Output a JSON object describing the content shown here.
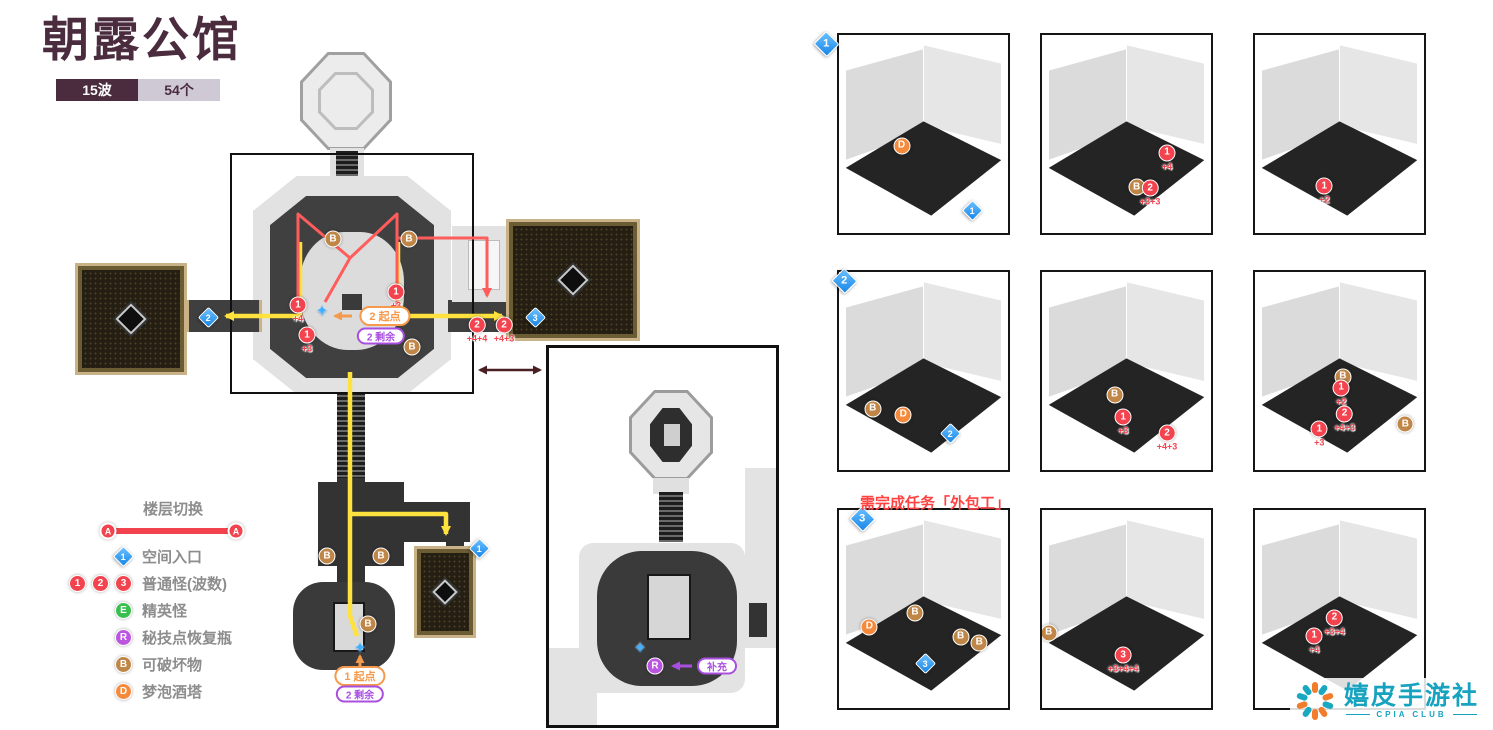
{
  "header": {
    "title": "朝露公馆",
    "wave_badge": "15波",
    "count_badge": "54个"
  },
  "legend": {
    "floor_switch": "楼层切换",
    "floor_marker": "A",
    "items": [
      {
        "type": "entry",
        "marker": "1",
        "label": "空间入口"
      },
      {
        "type": "waves",
        "markers": [
          "1",
          "2",
          "3"
        ],
        "label": "普通怪(波数)"
      },
      {
        "type": "elite",
        "marker": "E",
        "label": "精英怪"
      },
      {
        "type": "technique",
        "marker": "R",
        "label": "秘技点恢复瓶"
      },
      {
        "type": "breakable",
        "marker": "B",
        "label": "可破坏物"
      },
      {
        "type": "tower",
        "marker": "D",
        "label": "梦泡酒塔"
      }
    ]
  },
  "map": {
    "markers": [
      {
        "t": "entry",
        "label": "2",
        "x": 208,
        "y": 316
      },
      {
        "t": "entry",
        "label": "3",
        "x": 517,
        "y": 316
      },
      {
        "t": "entry",
        "label": "1",
        "x": 443,
        "y": 547
      },
      {
        "t": "wave",
        "label": "1",
        "sub": "+4",
        "x": 298,
        "y": 310
      },
      {
        "t": "wave",
        "label": "1",
        "sub": "+3",
        "x": 396,
        "y": 297
      },
      {
        "t": "wave",
        "label": "1",
        "sub": "+3",
        "x": 307,
        "y": 340
      },
      {
        "t": "wave",
        "label": "2",
        "sub": "+4+4",
        "x": 477,
        "y": 330
      },
      {
        "t": "wave",
        "label": "2",
        "sub": "+4+3",
        "x": 504,
        "y": 330
      },
      {
        "t": "b",
        "x": 412,
        "y": 347
      },
      {
        "t": "b",
        "x": 333,
        "y": 239
      },
      {
        "t": "b",
        "x": 409,
        "y": 239
      },
      {
        "t": "b",
        "x": 327,
        "y": 556
      },
      {
        "t": "b",
        "x": 381,
        "y": 556
      },
      {
        "t": "b",
        "x": 368,
        "y": 624
      },
      {
        "t": "star",
        "x": 322,
        "y": 311
      },
      {
        "t": "star",
        "x": 360,
        "y": 648
      },
      {
        "t": "star",
        "x": 640,
        "y": 648
      },
      {
        "t": "r",
        "x": 655,
        "y": 666
      }
    ],
    "pills": [
      {
        "style": "orange",
        "text": "2 起点",
        "x": 385,
        "y": 316
      },
      {
        "style": "purple",
        "text": "2 剩余",
        "x": 381,
        "y": 336
      },
      {
        "style": "orange",
        "text": "1 起点",
        "x": 360,
        "y": 676
      },
      {
        "style": "purple",
        "text": "2 剩余",
        "x": 360,
        "y": 694
      },
      {
        "style": "purple",
        "text": "补充",
        "x": 717,
        "y": 666
      }
    ],
    "routes": [
      {
        "color": "yellow",
        "points": [
          [
            300,
            242
          ],
          [
            300,
            316
          ],
          [
            226,
            316
          ]
        ],
        "arrow": "end",
        "dashed": false
      },
      {
        "color": "yellow",
        "points": [
          [
            398,
            242
          ],
          [
            398,
            316
          ],
          [
            502,
            316
          ]
        ],
        "arrow": "end",
        "dashed": false
      },
      {
        "color": "yellow",
        "points": [
          [
            350,
            372
          ],
          [
            350,
            514
          ],
          [
            446,
            514
          ],
          [
            446,
            534
          ]
        ],
        "arrow": "end",
        "dashed": false
      },
      {
        "color": "yellow",
        "points": [
          [
            350,
            514
          ],
          [
            350,
            616
          ],
          [
            357,
            636
          ]
        ],
        "arrow": "none",
        "dashed": false
      },
      {
        "color": "red",
        "points": [
          [
            298,
            306
          ],
          [
            298,
            214
          ],
          [
            350,
            258
          ]
        ],
        "arrow": "none",
        "dashed": false
      },
      {
        "color": "red",
        "points": [
          [
            397,
            306
          ],
          [
            397,
            214
          ],
          [
            350,
            258
          ]
        ],
        "arrow": "none",
        "dashed": false
      },
      {
        "color": "red",
        "points": [
          [
            397,
            238
          ],
          [
            487,
            238
          ],
          [
            487,
            296
          ]
        ],
        "arrow": "end",
        "dashed": false
      },
      {
        "color": "red",
        "points": [
          [
            350,
            258
          ],
          [
            325,
            302
          ]
        ],
        "arrow": "none",
        "dashed": false
      },
      {
        "color": "orange",
        "points": [
          [
            352,
            316
          ],
          [
            335,
            316
          ]
        ],
        "arrow": "end",
        "dashed": false
      },
      {
        "color": "orange",
        "points": [
          [
            360,
            667
          ],
          [
            360,
            656
          ]
        ],
        "arrow": "end",
        "dashed": false
      },
      {
        "color": "purple",
        "points": [
          [
            692,
            666
          ],
          [
            673,
            666
          ]
        ],
        "arrow": "end",
        "dashed": false
      },
      {
        "color": "maroon",
        "points": [
          [
            480,
            370
          ],
          [
            540,
            370
          ]
        ],
        "arrow": "both",
        "dashed": false
      }
    ]
  },
  "task_note": "需完成任务「外包工」",
  "rows": [
    {
      "num": "1"
    },
    {
      "num": "2"
    },
    {
      "num": "3"
    }
  ],
  "tiles": [
    {
      "markers": [
        {
          "t": "d",
          "x": 37,
          "y": 56
        },
        {
          "t": "entry",
          "label": "1",
          "x": 79,
          "y": 88
        }
      ],
      "paths": [
        {
          "points": [
            [
              78,
              84
            ],
            [
              60,
              73
            ],
            [
              73,
              62
            ]
          ],
          "arrow": "end",
          "dashed": false
        }
      ]
    },
    {
      "markers": [
        {
          "t": "b",
          "x": 56,
          "y": 77
        },
        {
          "t": "wave",
          "label": "1",
          "sub": "+4",
          "x": 74,
          "y": 62
        },
        {
          "t": "wave",
          "label": "2",
          "sub": "+3+3",
          "x": 64,
          "y": 80
        }
      ],
      "paths": [
        {
          "points": [
            [
              39,
              73
            ],
            [
              50,
              76
            ],
            [
              62,
              68
            ],
            [
              71,
              72
            ],
            [
              85,
              60
            ]
          ],
          "arrow": "end",
          "dashed": false
        }
      ]
    },
    {
      "markers": [
        {
          "t": "wave",
          "label": "1",
          "sub": "+2",
          "x": 41,
          "y": 79
        }
      ],
      "paths": [
        {
          "points": [
            [
              72,
              84
            ],
            [
              59,
              72
            ],
            [
              49,
              78
            ]
          ],
          "arrow": "end",
          "dashed": false
        }
      ]
    },
    {
      "markers": [
        {
          "t": "b",
          "x": 20,
          "y": 69
        },
        {
          "t": "d",
          "x": 38,
          "y": 72
        },
        {
          "t": "entry",
          "label": "2",
          "x": 66,
          "y": 81
        }
      ],
      "paths": [
        {
          "points": [
            [
              66,
              77
            ],
            [
              70,
              62
            ],
            [
              45,
              70
            ]
          ],
          "arrow": "end",
          "dashed": false
        },
        {
          "points": [
            [
              70,
              62
            ],
            [
              67,
              50
            ],
            [
              55,
              40
            ]
          ],
          "arrow": "none",
          "dashed": false
        },
        {
          "points": [
            [
              13,
              47
            ],
            [
              55,
              40
            ]
          ],
          "arrow": "both",
          "dashed": false
        }
      ]
    },
    {
      "markers": [
        {
          "t": "b",
          "x": 43,
          "y": 62
        },
        {
          "t": "wave",
          "label": "1",
          "sub": "+3",
          "x": 48,
          "y": 76
        },
        {
          "t": "wave",
          "label": "2",
          "sub": "+4+3",
          "x": 74,
          "y": 84
        }
      ],
      "paths": [
        {
          "points": [
            [
              3,
              62
            ],
            [
              70,
              81
            ]
          ],
          "arrow": "end",
          "dashed": false
        }
      ]
    },
    {
      "markers": [
        {
          "t": "b",
          "x": 52,
          "y": 53
        },
        {
          "t": "wave",
          "label": "1",
          "sub": "+2",
          "x": 51,
          "y": 61
        },
        {
          "t": "wave",
          "label": "2",
          "sub": "+4+3",
          "x": 53,
          "y": 74
        },
        {
          "t": "wave",
          "label": "1",
          "sub": "+3",
          "x": 38,
          "y": 82
        },
        {
          "t": "b",
          "x": 89,
          "y": 77
        }
      ],
      "paths": [
        {
          "points": [
            [
              69,
              88
            ],
            [
              69,
              64
            ],
            [
              59,
              57
            ]
          ],
          "arrow": "end",
          "dashed": false
        },
        {
          "points": [
            [
              58,
              70
            ],
            [
              41,
              78
            ]
          ],
          "arrow": "end",
          "dashed": false
        }
      ]
    },
    {
      "markers": [
        {
          "t": "d",
          "x": 18,
          "y": 59
        },
        {
          "t": "b",
          "x": 45,
          "y": 52
        },
        {
          "t": "b",
          "x": 72,
          "y": 64
        },
        {
          "t": "b",
          "x": 83,
          "y": 67
        },
        {
          "t": "entry",
          "label": "3",
          "x": 51,
          "y": 77
        }
      ],
      "paths": [
        {
          "points": [
            [
              51,
              73
            ],
            [
              33,
              71
            ],
            [
              20,
              64
            ],
            [
              38,
              58
            ],
            [
              58,
              58
            ],
            [
              58,
              51
            ]
          ],
          "arrow": "end",
          "dashed": false
        },
        {
          "points": [
            [
              70,
              48
            ],
            [
              84,
              45
            ],
            [
              81,
              25
            ],
            [
              44,
              16
            ]
          ],
          "arrow": "end",
          "dashed": true
        },
        {
          "points": [
            [
              44,
              16
            ],
            [
              10,
              24
            ],
            [
              8,
              56
            ]
          ],
          "arrow": "none",
          "dashed": true
        }
      ]
    },
    {
      "markers": [
        {
          "t": "b",
          "x": 4,
          "y": 62
        },
        {
          "t": "wave",
          "label": "3",
          "sub": "+3+4+4",
          "x": 48,
          "y": 76
        }
      ],
      "paths": []
    },
    {
      "markers": [
        {
          "t": "wave",
          "label": "2",
          "sub": "+3+4",
          "x": 47,
          "y": 57
        },
        {
          "t": "wave",
          "label": "1",
          "sub": "+4",
          "x": 35,
          "y": 66
        }
      ],
      "paths": [
        {
          "points": [
            [
              6,
              20
            ],
            [
              32,
              14
            ],
            [
              55,
              22
            ],
            [
              55,
              30
            ]
          ],
          "arrow": "none",
          "dashed": true
        },
        {
          "points": [
            [
              4,
              68
            ],
            [
              20,
              76
            ],
            [
              45,
              71
            ],
            [
              78,
              84
            ]
          ],
          "arrow": "none",
          "dashed": true
        }
      ]
    }
  ],
  "watermark": {
    "name": "嬉皮手游社",
    "club": "CPIA CLUB",
    "logo_colors": [
      "#f07c2c",
      "#1aa7c0",
      "#f07c2c",
      "#1aa7c0",
      "#f07c2c",
      "#f07c2c",
      "#1aa7c0",
      "#f07c2c",
      "#1aa7c0",
      "#1aa7c0"
    ]
  },
  "colors": {
    "title_maroon": "#4a2c3e",
    "badge_light": "#cfc9d6",
    "marker_red": "#f2434e",
    "marker_blue": "#1f8fee",
    "marker_green": "#37c04e",
    "marker_purple": "#bb55e0",
    "marker_brown": "#c08647",
    "marker_orange": "#f58a3d",
    "route_yellow": "#ffe23e",
    "route_red": "#ff5c5c",
    "pill_orange": "#f59a4c",
    "pill_purple": "#a94fe0",
    "watermark_teal": "#17a3bf"
  }
}
